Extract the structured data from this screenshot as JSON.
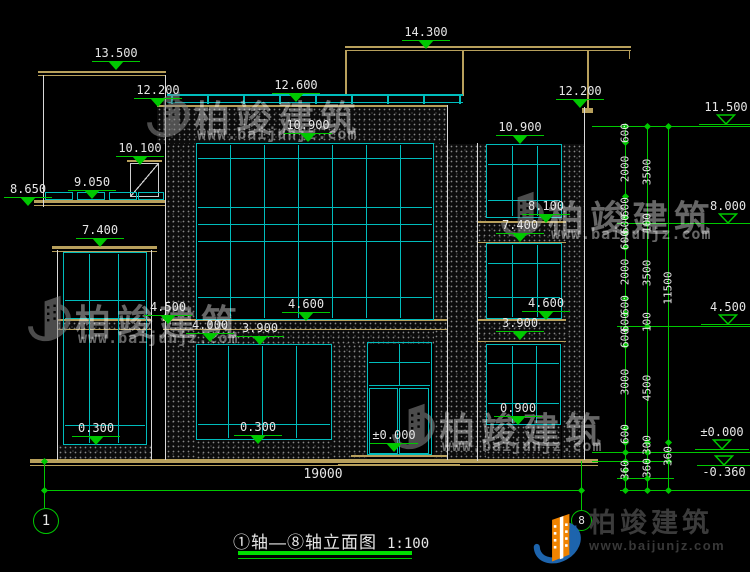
{
  "title": {
    "axis_label": "①轴—⑧轴立面图",
    "scale": "1:100"
  },
  "axis_bubbles": {
    "left": "1",
    "right": "8"
  },
  "bottom_dimension": "19000",
  "elevation_markers": [
    {
      "label": "13.500",
      "x": 88,
      "y": 47,
      "style": "filled"
    },
    {
      "label": "12.200",
      "x": 130,
      "y": 84,
      "style": "filled"
    },
    {
      "label": "14.300",
      "x": 398,
      "y": 26,
      "style": "filled"
    },
    {
      "label": "12.600",
      "x": 268,
      "y": 79,
      "style": "filled"
    },
    {
      "label": "12.200",
      "x": 552,
      "y": 85,
      "style": "filled"
    },
    {
      "label": "10.100",
      "x": 112,
      "y": 142,
      "style": "filled"
    },
    {
      "label": "9.050",
      "x": 64,
      "y": 176,
      "style": "filled"
    },
    {
      "label": "8.650",
      "x": 0,
      "y": 183,
      "style": "filled"
    },
    {
      "label": "10.900",
      "x": 280,
      "y": 119,
      "style": "filled"
    },
    {
      "label": "10.900",
      "x": 492,
      "y": 121,
      "style": "filled"
    },
    {
      "label": "8.100",
      "x": 518,
      "y": 200,
      "style": "filled"
    },
    {
      "label": "7.400",
      "x": 72,
      "y": 224,
      "style": "filled"
    },
    {
      "label": "7.400",
      "x": 492,
      "y": 219,
      "style": "filled"
    },
    {
      "label": "4.500",
      "x": 140,
      "y": 301,
      "style": "filled"
    },
    {
      "label": "4.000",
      "x": 182,
      "y": 319,
      "style": "filled"
    },
    {
      "label": "3.900",
      "x": 232,
      "y": 322,
      "style": "filled"
    },
    {
      "label": "4.600",
      "x": 278,
      "y": 298,
      "style": "filled"
    },
    {
      "label": "4.600",
      "x": 518,
      "y": 297,
      "style": "filled"
    },
    {
      "label": "3.900",
      "x": 492,
      "y": 317,
      "style": "filled"
    },
    {
      "label": "0.300",
      "x": 68,
      "y": 422,
      "style": "filled"
    },
    {
      "label": "0.300",
      "x": 230,
      "y": 421,
      "style": "filled"
    },
    {
      "label": "±0.000",
      "x": 366,
      "y": 429,
      "style": "filled"
    },
    {
      "label": "0.900",
      "x": 490,
      "y": 402,
      "style": "filled"
    },
    {
      "label": "11.500",
      "x": 698,
      "y": 101,
      "style": "open"
    },
    {
      "label": "8.000",
      "x": 700,
      "y": 200,
      "style": "open"
    },
    {
      "label": "4.500",
      "x": 700,
      "y": 301,
      "style": "open"
    },
    {
      "label": "±0.000",
      "x": 694,
      "y": 426,
      "style": "open"
    },
    {
      "label": "-0.360",
      "x": 696,
      "y": 455,
      "style": "open_below"
    }
  ],
  "vertical_dims": [
    {
      "label": "600",
      "x": 625,
      "y": 133
    },
    {
      "label": "2000",
      "x": 625,
      "y": 169
    },
    {
      "label": "3500",
      "x": 647,
      "y": 172
    },
    {
      "label": "600",
      "x": 625,
      "y": 207
    },
    {
      "label": "600",
      "x": 625,
      "y": 224
    },
    {
      "label": "600",
      "x": 625,
      "y": 240
    },
    {
      "label": "100",
      "x": 647,
      "y": 223
    },
    {
      "label": "2000",
      "x": 625,
      "y": 272
    },
    {
      "label": "3500",
      "x": 647,
      "y": 273
    },
    {
      "label": "11500",
      "x": 668,
      "y": 288
    },
    {
      "label": "600",
      "x": 625,
      "y": 305
    },
    {
      "label": "600",
      "x": 625,
      "y": 322
    },
    {
      "label": "600",
      "x": 625,
      "y": 338
    },
    {
      "label": "100",
      "x": 647,
      "y": 322
    },
    {
      "label": "3000",
      "x": 625,
      "y": 382
    },
    {
      "label": "4500",
      "x": 647,
      "y": 388
    },
    {
      "label": "600",
      "x": 625,
      "y": 434
    },
    {
      "label": "300",
      "x": 647,
      "y": 445
    },
    {
      "label": "360",
      "x": 668,
      "y": 456
    },
    {
      "label": "360",
      "x": 647,
      "y": 468
    },
    {
      "label": "360",
      "x": 625,
      "y": 470
    }
  ],
  "watermark": {
    "brand": "柏竣建筑",
    "site": "www.baijunjz.com",
    "positions": [
      {
        "x": 146,
        "y": 86
      },
      {
        "x": 27,
        "y": 290
      },
      {
        "x": 500,
        "y": 186
      },
      {
        "x": 391,
        "y": 398
      }
    ]
  },
  "logo": {
    "brand": "柏竣建筑",
    "site": "www.baijunjz.com"
  },
  "colors": {
    "dimension_green": "#00c800",
    "frame_cyan": "#00bcbc",
    "slab_tan": "#b8a05c",
    "text_white": "#e6e6e6",
    "logo_blue": "#1d64ad",
    "logo_orange": "#f08300"
  }
}
